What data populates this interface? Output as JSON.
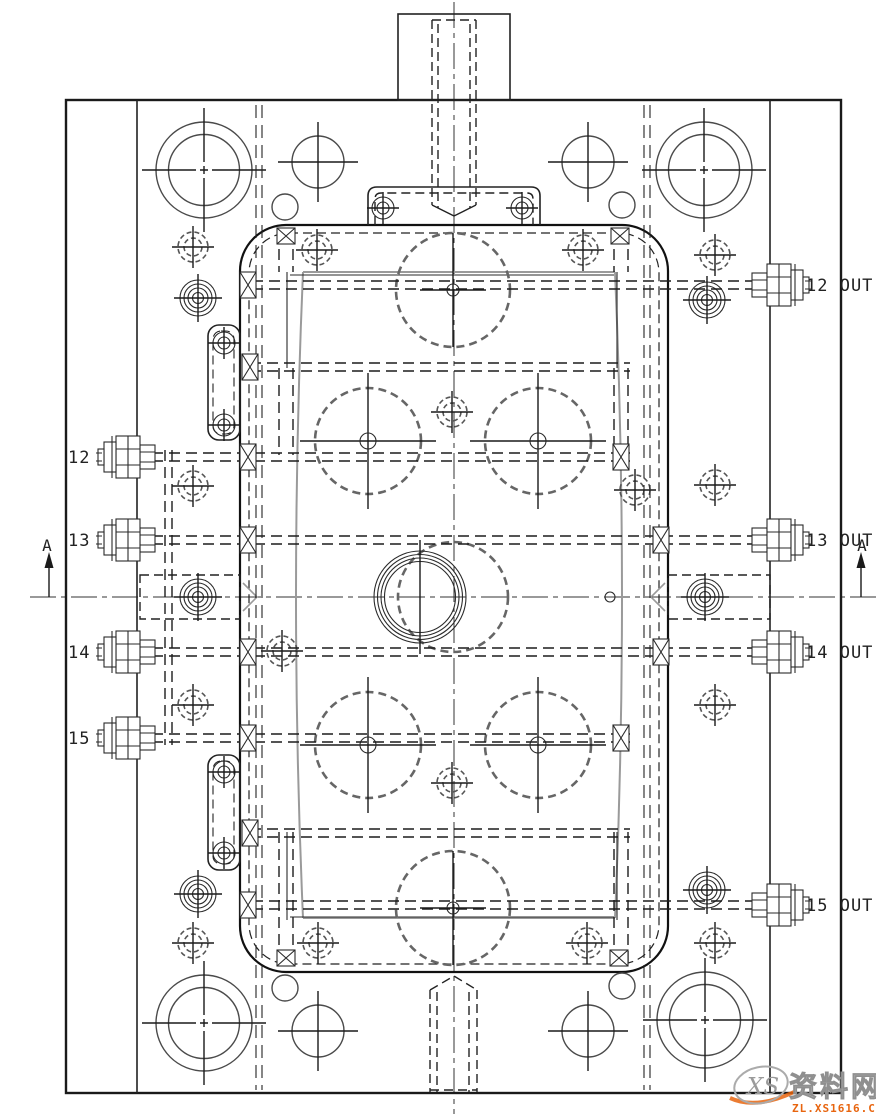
{
  "drawing_type": "mold-plate-cooling-layout",
  "section": {
    "marker": "A"
  },
  "ports": {
    "left": [
      {
        "label": "12 IN"
      },
      {
        "label": "13 IN"
      },
      {
        "label": "14 IN"
      },
      {
        "label": "15 IN"
      }
    ],
    "right": [
      {
        "label": "12 OUT"
      },
      {
        "label": "13 OUT"
      },
      {
        "label": "14 OUT"
      },
      {
        "label": "15 OUT"
      }
    ]
  },
  "watermark": {
    "logo_text": "XS",
    "name": "资料网",
    "url": "ZL.XS1616.COM"
  },
  "colors": {
    "line": "#1a1a1a",
    "hidden_line": "#666666",
    "gray_line": "#9a9a9a",
    "accent_orange": "#e8650f",
    "watermark_gray": "#cdcdcd"
  }
}
